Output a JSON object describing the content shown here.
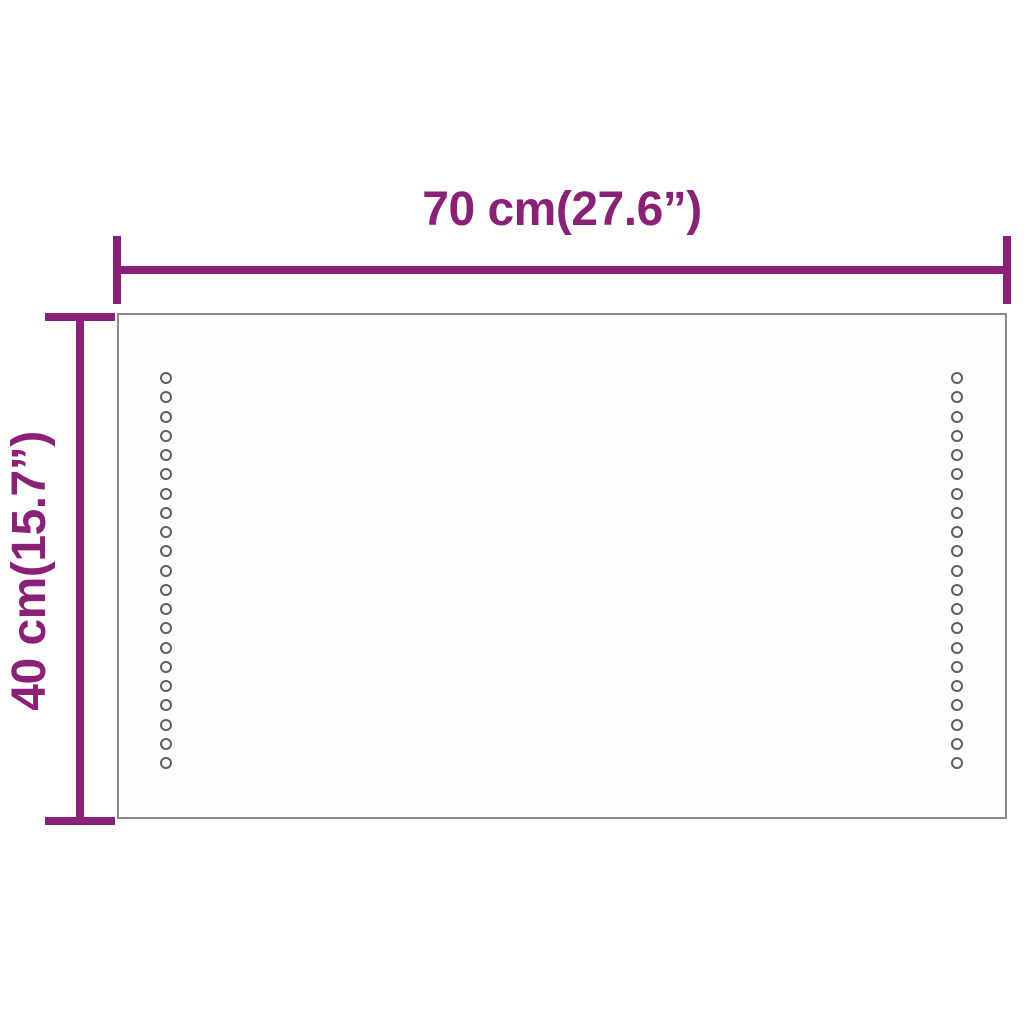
{
  "diagram": {
    "width_dimension": {
      "label": "70 cm(27.6”)"
    },
    "height_dimension": {
      "label": "40 cm(15.7”)"
    },
    "mirror": {
      "led_dot_columns": 2,
      "led_dots_per_column": 21
    },
    "colors": {
      "dimension_accent": "#8a2177",
      "mirror_border": "#8a8a8a",
      "led_dot": "#5e5e5e"
    }
  }
}
